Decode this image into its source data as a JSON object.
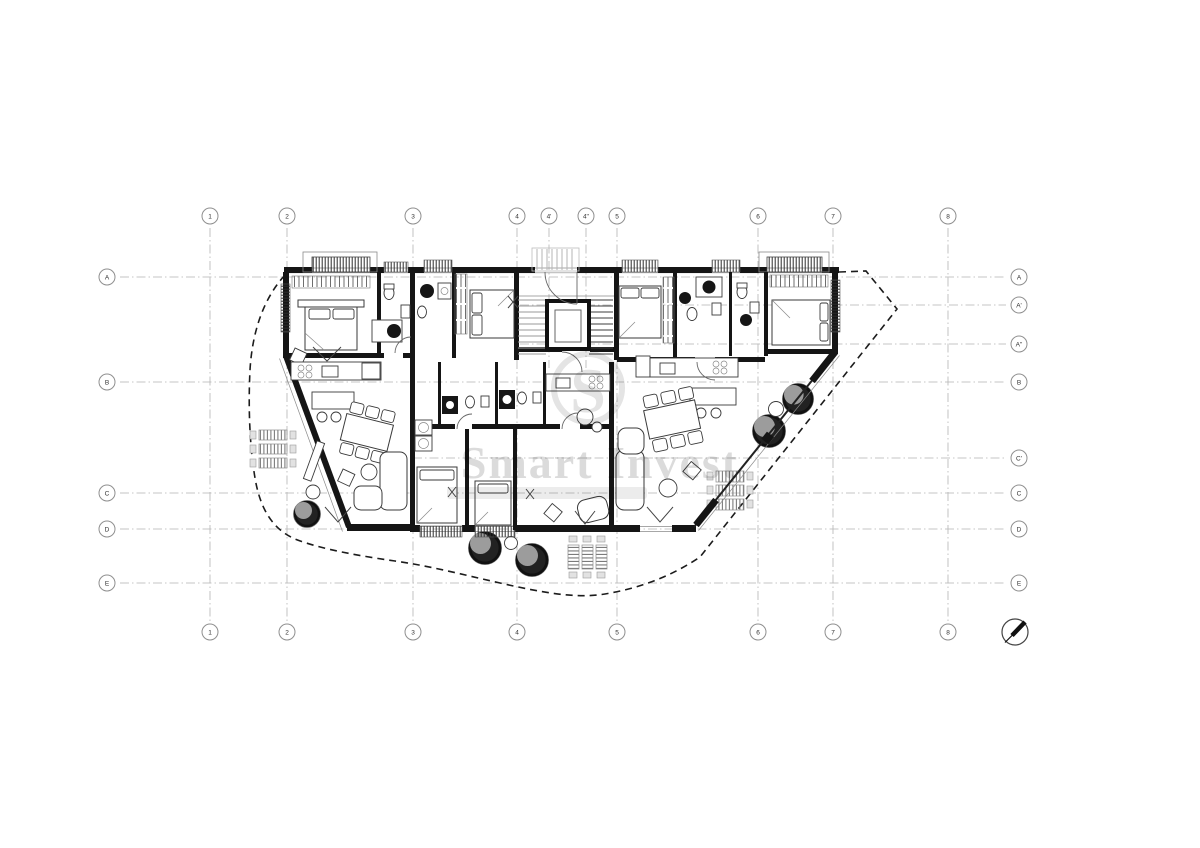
{
  "drawing": {
    "type": "architectural-floor-plan"
  },
  "watermark": {
    "logo_letter": "S",
    "brand": "Smart Invest"
  },
  "grid": {
    "bubble_radius": 8,
    "top_bubble_y": 216,
    "bottom_bubble_y": 632,
    "left_bubble_x": 107,
    "right_bubble_x": 1019,
    "line_y1": 228,
    "line_y2": 622,
    "short_line_y2": 368,
    "line_x1": 120,
    "line_x2": 1006,
    "columns": [
      {
        "label": "1",
        "x": 210,
        "top": true,
        "bottom": true,
        "short": false
      },
      {
        "label": "2",
        "x": 287,
        "top": true,
        "bottom": true,
        "short": false
      },
      {
        "label": "3",
        "x": 413,
        "top": true,
        "bottom": true,
        "short": false
      },
      {
        "label": "4",
        "x": 517,
        "top": true,
        "bottom": true,
        "short": false
      },
      {
        "label": "4'",
        "x": 549,
        "top": true,
        "bottom": false,
        "short": true
      },
      {
        "label": "4''",
        "x": 586,
        "top": true,
        "bottom": false,
        "short": true
      },
      {
        "label": "5",
        "x": 617,
        "top": true,
        "bottom": true,
        "short": false
      },
      {
        "label": "6",
        "x": 758,
        "top": true,
        "bottom": true,
        "short": false
      },
      {
        "label": "7",
        "x": 833,
        "top": true,
        "bottom": true,
        "short": false
      },
      {
        "label": "8",
        "x": 948,
        "top": true,
        "bottom": true,
        "short": false
      }
    ],
    "rows": [
      {
        "label": "A",
        "y": 277,
        "left": true,
        "right": true,
        "x1": 120
      },
      {
        "label": "A'",
        "y": 305,
        "left": false,
        "right": true,
        "x1": 520
      },
      {
        "label": "A''",
        "y": 344,
        "left": false,
        "right": true,
        "x1": 520
      },
      {
        "label": "B",
        "y": 382,
        "left": true,
        "right": true,
        "x1": 120
      },
      {
        "label": "C'",
        "y": 458,
        "left": false,
        "right": true,
        "x1": 413
      },
      {
        "label": "C",
        "y": 493,
        "left": true,
        "right": true,
        "x1": 120
      },
      {
        "label": "D",
        "y": 529,
        "left": true,
        "right": true,
        "x1": 120
      },
      {
        "label": "E",
        "y": 583,
        "left": true,
        "right": true,
        "x1": 120
      }
    ]
  },
  "colors": {
    "background": "#ffffff",
    "wall": "#151515",
    "grid": "#b4b4b4",
    "boundary": "#1c1c1c",
    "tree_fill": "#9c9c9c",
    "watermark": "#bdbdbd"
  }
}
